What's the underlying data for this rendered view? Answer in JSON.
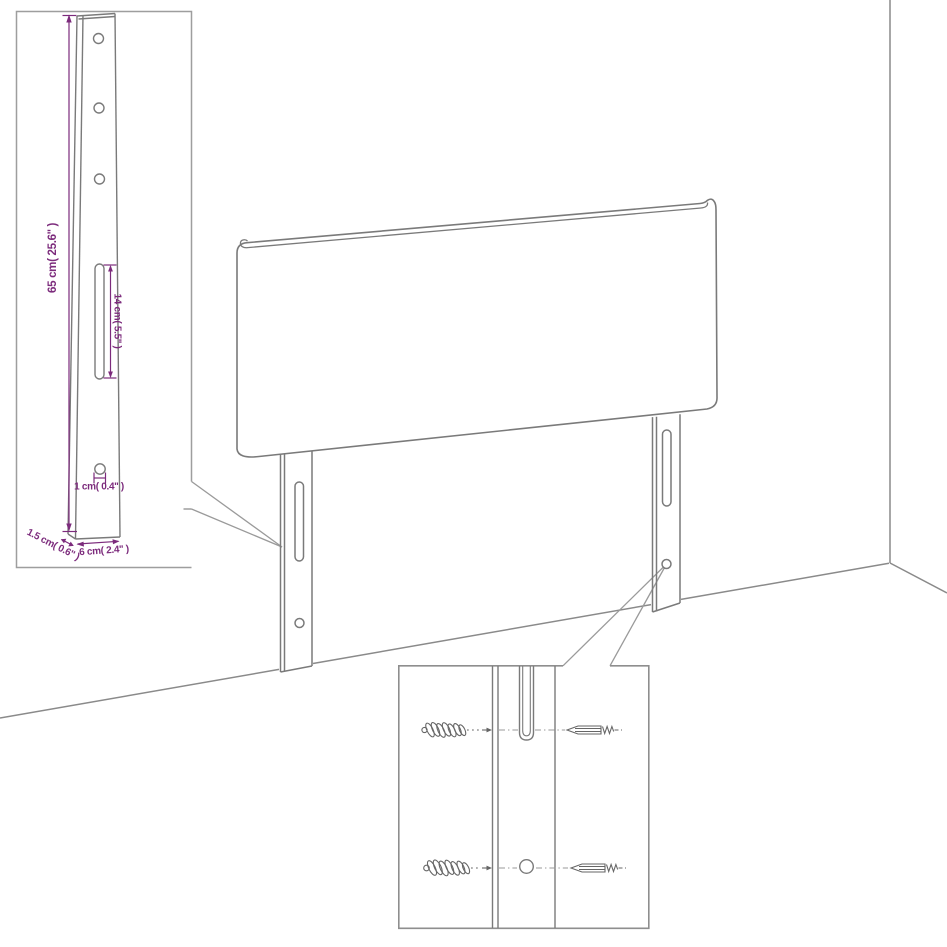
{
  "canvas": {
    "width": 947,
    "height": 947,
    "background": "#ffffff"
  },
  "colors": {
    "line": "#7a7a7a",
    "room_line": "#8a8a8a",
    "inset_border": "#9e9e9e",
    "dimension": "#7c2b7c",
    "hardware": "#666666"
  },
  "leg_detail_inset": {
    "dim_height": "65 cm( 25.6'' )",
    "dim_slot_length": "14 cm( 5.5'' )",
    "dim_hole_diameter": "1 cm( 0.4'' )",
    "dim_thickness": "1.5 cm( 0.6'' )",
    "dim_leg_width": "6 cm( 2.4'' )"
  }
}
